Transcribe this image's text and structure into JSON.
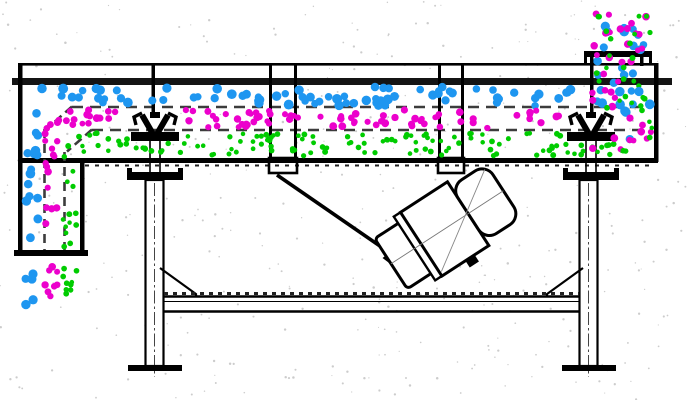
{
  "meta": {
    "description": "Side-view engineering diagram of a linear vibrating screen separating mixed feed into three particle streams",
    "canvas": {
      "width": 690,
      "height": 400
    },
    "background": "#ffffff"
  },
  "palette": {
    "line": "#000000",
    "rail": "#141414",
    "dash": "#3c3c3c",
    "tick": "#222222",
    "centerline": "#444444",
    "speckle": "#cccccc"
  },
  "particle_layers": [
    {
      "id": "coarse",
      "name": "coarse-particles",
      "color": "#1E96F0",
      "radius": 4.3
    },
    {
      "id": "medium",
      "name": "medium-particles",
      "color": "#EC00CC",
      "radius": 3.4
    },
    {
      "id": "fine",
      "name": "fine-particles",
      "color": "#00CC00",
      "radius": 2.6
    }
  ],
  "particle_fields": [
    {
      "layer": "coarse",
      "x": 28,
      "y": 87,
      "w": 552,
      "h": 19,
      "n": 76,
      "seed": 11
    },
    {
      "layer": "medium",
      "x": 50,
      "y": 110,
      "w": 548,
      "h": 18,
      "n": 90,
      "seed": 12
    },
    {
      "layer": "fine",
      "x": 68,
      "y": 133,
      "w": 556,
      "h": 23,
      "n": 128,
      "seed": 13
    },
    {
      "layer": "coarse",
      "x": 25,
      "y": 106,
      "w": 14,
      "h": 142,
      "n": 15,
      "seed": 21
    },
    {
      "layer": "medium",
      "x": 45,
      "y": 128,
      "w": 15,
      "h": 120,
      "n": 15,
      "seed": 22
    },
    {
      "layer": "fine",
      "x": 63,
      "y": 150,
      "w": 14,
      "h": 98,
      "n": 13,
      "seed": 23
    },
    {
      "layer": "coarse",
      "x": 25,
      "y": 258,
      "w": 12,
      "h": 50,
      "n": 5,
      "seed": 31
    },
    {
      "layer": "medium",
      "x": 45,
      "y": 258,
      "w": 14,
      "h": 48,
      "n": 8,
      "seed": 32
    },
    {
      "layer": "fine",
      "x": 63,
      "y": 256,
      "w": 14,
      "h": 46,
      "n": 9,
      "seed": 33
    },
    {
      "layer": "coarse",
      "x": 596,
      "y": 12,
      "w": 52,
      "h": 74,
      "n": 16,
      "seed": 41
    },
    {
      "layer": "medium",
      "x": 594,
      "y": 10,
      "w": 56,
      "h": 76,
      "n": 20,
      "seed": 42
    },
    {
      "layer": "fine",
      "x": 596,
      "y": 12,
      "w": 54,
      "h": 74,
      "n": 18,
      "seed": 43
    },
    {
      "layer": "coarse",
      "x": 592,
      "y": 86,
      "w": 60,
      "h": 58,
      "n": 12,
      "seed": 51
    },
    {
      "layer": "medium",
      "x": 592,
      "y": 90,
      "w": 61,
      "h": 64,
      "n": 16,
      "seed": 52
    },
    {
      "layer": "fine",
      "x": 594,
      "y": 92,
      "w": 59,
      "h": 62,
      "n": 14,
      "seed": 53
    }
  ],
  "avoid_zones": [
    {
      "x": 127,
      "y": 109,
      "w": 56,
      "h": 34
    },
    {
      "x": 563,
      "y": 109,
      "w": 50,
      "h": 34
    }
  ],
  "speckles": {
    "count": 430,
    "radius": 0.9,
    "seed": 7
  }
}
